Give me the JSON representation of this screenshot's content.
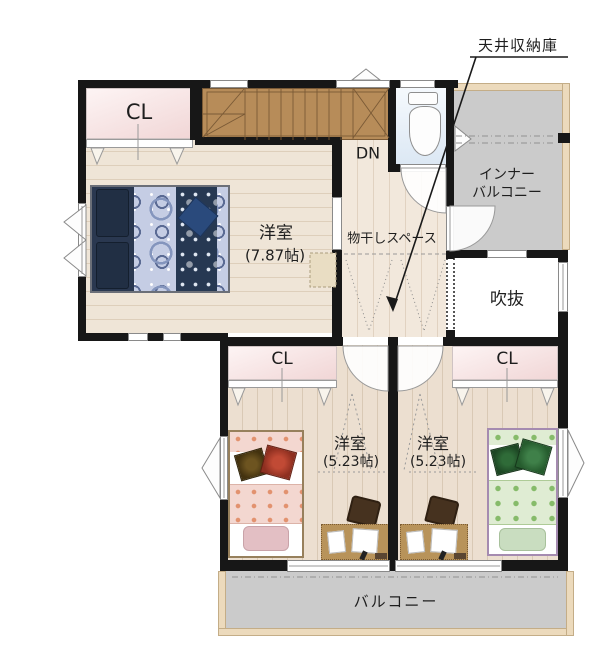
{
  "callout": {
    "label": "天井収納庫"
  },
  "rooms": {
    "closet_top": {
      "label": "CL"
    },
    "stairs": {
      "label": "DN"
    },
    "main_bedroom": {
      "name": "洋室",
      "size": "(7.87帖)"
    },
    "drying_space": {
      "label": "物干しスペース"
    },
    "inner_balcony": {
      "line1": "インナー",
      "line2": "バルコニー"
    },
    "void": {
      "label": "吹抜"
    },
    "closet_left": {
      "label": "CL"
    },
    "closet_right": {
      "label": "CL"
    },
    "bedroom_left": {
      "name": "洋室",
      "size": "(5.23帖)"
    },
    "bedroom_right": {
      "name": "洋室",
      "size": "(5.23帖)"
    },
    "balcony": {
      "label": "バルコニー"
    }
  },
  "colors": {
    "wall": "#171717",
    "stairs": "#b78c59",
    "closet_pink": "#f1d6d6",
    "balcony_gray": "#cbcbcb",
    "balcony_frame": "#ecdabc",
    "wood": "#ecdfd0",
    "bed_blue": "#2a3850",
    "bed_pink": "#f3d7d0",
    "bed_green": "#dfecd3",
    "toilet_floor": "#dce8f4"
  }
}
